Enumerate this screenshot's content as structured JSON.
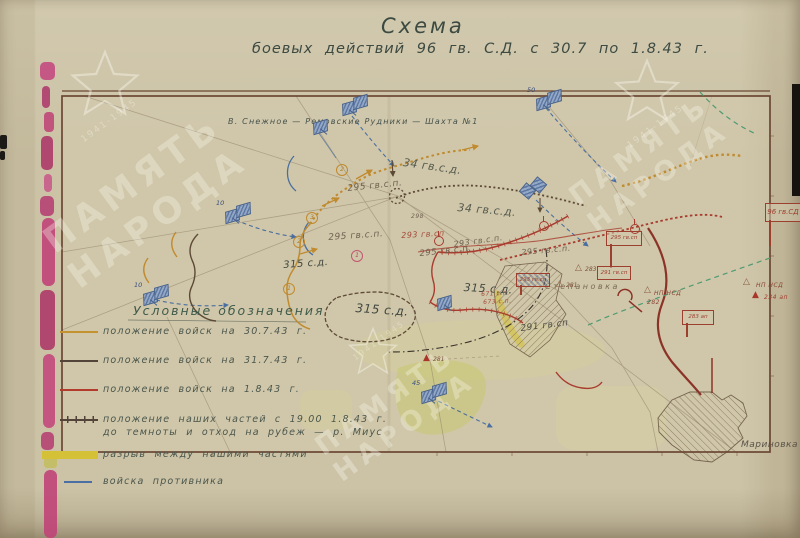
{
  "title": {
    "line1": "Схема",
    "line2": "боевых  действий  96 гв. С.Д.  с 30.7 по 1.8.43 г."
  },
  "watermark": {
    "word1": "ПАМЯТЬ",
    "word2": "НАРОДА",
    "years": "1941-1945"
  },
  "legend": {
    "heading": "Условные обозначения",
    "items": [
      {
        "label": "положение войск на 30.7.43 г.",
        "y": 326,
        "sample": {
          "x": 60,
          "w": 38,
          "color": "#c49330",
          "h": 2
        }
      },
      {
        "label": "положение войск на 31.7.43 г.",
        "y": 355,
        "sample": {
          "x": 60,
          "w": 38,
          "color": "#53443a",
          "h": 2
        }
      },
      {
        "label": "положение войск на 1.8.43 г.",
        "y": 384,
        "sample": {
          "x": 60,
          "w": 38,
          "color": "#b23b2c",
          "h": 2
        }
      },
      {
        "label": "положение наших частей с 19.00 1.8.43 г.",
        "label2": "до темноты и отход на рубеж — р. Миус",
        "y": 414,
        "sample": {
          "x": 60,
          "w": 38,
          "color": "#53443a",
          "h": 7,
          "ticks": true
        }
      },
      {
        "label": "разрыв между нашими частями",
        "y": 449,
        "sample": {
          "x": 42,
          "w": 56,
          "color": "#d4c138",
          "h": 8
        }
      },
      {
        "label": "войска противника",
        "y": 476,
        "sample": {
          "x": 64,
          "w": 28,
          "color": "#4a6fa5",
          "h": 2
        }
      }
    ]
  },
  "map": {
    "labels": [
      {
        "t": "В. Снежное — Ремовские Рудники — Шахта №1",
        "x": 228,
        "y": 117,
        "r": 0,
        "c": "#46524b",
        "s": 8,
        "ls": 1.2
      },
      {
        "t": "34 гв.с.д.",
        "x": 404,
        "y": 156,
        "r": 8,
        "c": "#565a4e",
        "s": 11
      },
      {
        "t": "34 гв.с.д.",
        "x": 458,
        "y": 201,
        "r": 5,
        "c": "#565a4e",
        "s": 11
      },
      {
        "t": "295 гв.с.п.",
        "x": 347,
        "y": 184,
        "r": -6,
        "c": "#6f6252",
        "s": 9
      },
      {
        "t": "295 гв.с.п.",
        "x": 328,
        "y": 233,
        "r": -4,
        "c": "#6f6252",
        "s": 9
      },
      {
        "t": "295 гв.с.п.",
        "x": 419,
        "y": 249,
        "r": -6,
        "c": "#6f6252",
        "s": 8.5
      },
      {
        "t": "295 гв.с.п.",
        "x": 521,
        "y": 248,
        "r": -5,
        "c": "#6f6252",
        "s": 8
      },
      {
        "t": "293 гв.сп",
        "x": 401,
        "y": 231,
        "r": -3,
        "c": "#a24a38",
        "s": 8
      },
      {
        "t": "293 гв.с.п.",
        "x": 453,
        "y": 240,
        "r": -8,
        "c": "#6f6252",
        "s": 8
      },
      {
        "t": "298",
        "x": 411,
        "y": 213,
        "r": 0,
        "c": "#6f6252",
        "s": 6
      },
      {
        "t": "315 с.д.",
        "x": 283,
        "y": 260,
        "r": -4,
        "c": "#3f463f",
        "s": 10
      },
      {
        "t": "315 с.д.",
        "x": 464,
        "y": 281,
        "r": 3,
        "c": "#3f463f",
        "s": 11
      },
      {
        "t": "315 с.д.",
        "x": 356,
        "y": 301,
        "r": 4,
        "c": "#3f463f",
        "s": 12
      },
      {
        "t": "671 с.п.",
        "x": 481,
        "y": 291,
        "r": -3,
        "c": "#a24a38",
        "s": 6
      },
      {
        "t": "673 с.п.",
        "x": 483,
        "y": 299,
        "r": -3,
        "c": "#a24a38",
        "s": 6
      },
      {
        "t": "291 гв.сп",
        "x": 520,
        "y": 324,
        "r": -7,
        "c": "#4c4c42",
        "s": 9
      },
      {
        "t": "Степановка",
        "x": 545,
        "y": 282,
        "r": 0,
        "c": "#7a6c56",
        "s": 8,
        "ls": 2.5
      },
      {
        "t": "Мариновка",
        "x": 741,
        "y": 440,
        "r": 0,
        "c": "#5a5348",
        "s": 9
      },
      {
        "t": "НП НСД",
        "x": 654,
        "y": 290,
        "r": 0,
        "c": "#8a4434",
        "s": 6
      },
      {
        "t": "282",
        "x": 647,
        "y": 299,
        "r": 0,
        "c": "#8a4434",
        "s": 6
      },
      {
        "t": "НП НСД",
        "x": 756,
        "y": 282,
        "r": 0,
        "c": "#8a4434",
        "s": 6
      },
      {
        "t": "234 ап",
        "x": 764,
        "y": 294,
        "r": 0,
        "c": "#a23b2c",
        "s": 6
      }
    ],
    "unit_boxes": [
      {
        "t": "295 гв.сп",
        "x": 606,
        "y": 231,
        "w": 34,
        "h": 13,
        "pole": 24
      },
      {
        "t": "291 гв.сп",
        "x": 597,
        "y": 266,
        "w": 32,
        "h": 12,
        "pole": 0
      },
      {
        "t": "293 гв.сп",
        "x": 516,
        "y": 273,
        "w": 32,
        "h": 12,
        "pole": 10,
        "hatch": true
      },
      {
        "t": "283 ап",
        "x": 682,
        "y": 310,
        "w": 30,
        "h": 13,
        "pole": 14
      },
      {
        "t": "96 гв.СД",
        "x": 765,
        "y": 203,
        "w": 34,
        "h": 17,
        "pole": 26,
        "big": true
      }
    ],
    "triangles": [
      {
        "n": "283",
        "x": 575,
        "y": 264,
        "fill": false
      },
      {
        "n": "281",
        "x": 556,
        "y": 280,
        "fill": false
      },
      {
        "n": "281",
        "x": 423,
        "y": 354,
        "fill": true
      },
      {
        "n": "",
        "x": 743,
        "y": 278,
        "fill": false
      },
      {
        "n": "",
        "x": 752,
        "y": 291,
        "fill": true
      },
      {
        "n": "",
        "x": 644,
        "y": 286,
        "fill": false
      }
    ],
    "flags": [
      {
        "x": 342,
        "y": 98,
        "n": "",
        "type": "pair"
      },
      {
        "x": 536,
        "y": 93,
        "n": "50",
        "type": "pair"
      },
      {
        "x": 313,
        "y": 117,
        "n": "",
        "type": "single"
      },
      {
        "x": 225,
        "y": 206,
        "n": "10",
        "type": "pair"
      },
      {
        "x": 143,
        "y": 288,
        "n": "10",
        "type": "pair"
      },
      {
        "x": 421,
        "y": 386,
        "n": "45",
        "type": "pair"
      },
      {
        "x": 521,
        "y": 181,
        "n": "",
        "type": "diamond"
      },
      {
        "x": 437,
        "y": 293,
        "n": "",
        "type": "single"
      }
    ],
    "circled_numbers": [
      {
        "n": "3",
        "x": 306,
        "y": 212,
        "pink": false
      },
      {
        "n": "2",
        "x": 293,
        "y": 236,
        "pink": false
      },
      {
        "n": "2",
        "x": 336,
        "y": 164,
        "pink": false
      },
      {
        "n": "1",
        "x": 283,
        "y": 283,
        "pink": false
      },
      {
        "n": "1",
        "x": 351,
        "y": 250,
        "pink": true
      }
    ],
    "red_flag_marks": [
      {
        "x": 434,
        "y": 236
      },
      {
        "x": 539,
        "y": 221
      },
      {
        "x": 630,
        "y": 224
      }
    ]
  }
}
